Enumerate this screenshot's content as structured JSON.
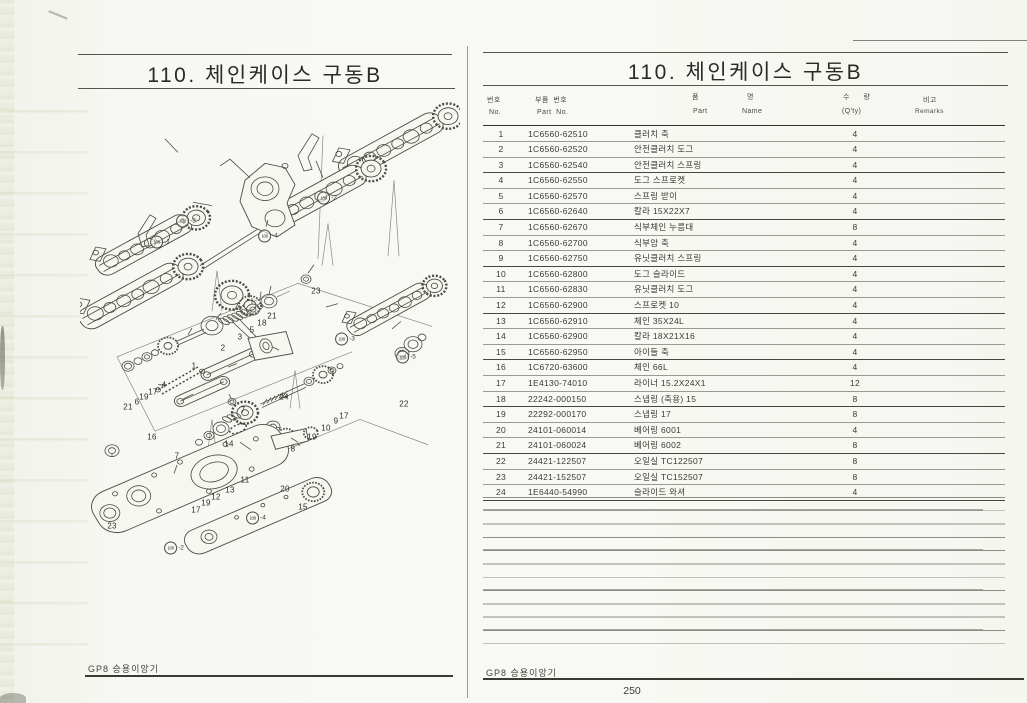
{
  "colors": {
    "paper": "#f6f6f2",
    "ink": "#3c3c36",
    "rule": "#8d8d85"
  },
  "left_page": {
    "title": "110. 체인케이스 구동B",
    "footer": "GP8 승용이앙기",
    "diagram": {
      "callouts": [
        {
          "label": "1",
          "x": 194,
          "y": 366
        },
        {
          "label": "2",
          "x": 223,
          "y": 348
        },
        {
          "label": "3",
          "x": 240,
          "y": 337
        },
        {
          "label": "4",
          "x": 164,
          "y": 385
        },
        {
          "label": "5",
          "x": 252,
          "y": 330
        },
        {
          "label": "6",
          "x": 137,
          "y": 402
        },
        {
          "label": "7",
          "x": 243,
          "y": 410
        },
        {
          "label": "7",
          "x": 177,
          "y": 456
        },
        {
          "label": "8",
          "x": 293,
          "y": 449
        },
        {
          "label": "9",
          "x": 336,
          "y": 421
        },
        {
          "label": "10",
          "x": 326,
          "y": 428
        },
        {
          "label": "11",
          "x": 245,
          "y": 480
        },
        {
          "label": "12",
          "x": 216,
          "y": 497
        },
        {
          "label": "13",
          "x": 230,
          "y": 490
        },
        {
          "label": "14",
          "x": 229,
          "y": 444
        },
        {
          "label": "15",
          "x": 303,
          "y": 507
        },
        {
          "label": "16",
          "x": 152,
          "y": 437
        },
        {
          "label": "17",
          "x": 153,
          "y": 392
        },
        {
          "label": "17",
          "x": 344,
          "y": 416
        },
        {
          "label": "17",
          "x": 196,
          "y": 510
        },
        {
          "label": "18",
          "x": 262,
          "y": 323
        },
        {
          "label": "19",
          "x": 144,
          "y": 397
        },
        {
          "label": "19",
          "x": 312,
          "y": 437
        },
        {
          "label": "19",
          "x": 206,
          "y": 503
        },
        {
          "label": "20",
          "x": 285,
          "y": 489
        },
        {
          "label": "21",
          "x": 272,
          "y": 316
        },
        {
          "label": "21",
          "x": 128,
          "y": 407
        },
        {
          "label": "22",
          "x": 404,
          "y": 404
        },
        {
          "label": "23",
          "x": 316,
          "y": 291
        },
        {
          "label": "23",
          "x": 112,
          "y": 526
        },
        {
          "label": "24",
          "x": 284,
          "y": 397
        }
      ],
      "ref_callouts": [
        {
          "text": "108",
          "suffix": "-1",
          "x": 160,
          "y": 242
        },
        {
          "text": "108",
          "suffix": "-2",
          "x": 327,
          "y": 198
        },
        {
          "text": "108",
          "suffix": "-3",
          "x": 186,
          "y": 221
        },
        {
          "text": "108",
          "suffix": "-4",
          "x": 268,
          "y": 236
        },
        {
          "text": "108",
          "suffix": "-3",
          "x": 345,
          "y": 339
        },
        {
          "text": "108",
          "suffix": "-5",
          "x": 406,
          "y": 357
        },
        {
          "text": "108",
          "suffix": "-4",
          "x": 256,
          "y": 518
        },
        {
          "text": "108",
          "suffix": "-2",
          "x": 174,
          "y": 548
        }
      ]
    }
  },
  "right_page": {
    "title": "110. 체인케이스 구동B",
    "footer": "GP8 승용이앙기",
    "page_number": "250",
    "table": {
      "headers": {
        "no_kr": "번호",
        "no_en": "No.",
        "part_kr": "부품  번호",
        "part_en": "Part  No.",
        "name_kr_a": "품",
        "name_kr_b": "명",
        "name_en_a": "Part",
        "name_en_b": "Name",
        "qty_kr": "수 량",
        "qty_en": "(Q'ty)",
        "remarks_kr": "비고",
        "remarks_en": "Remarks"
      },
      "rows": [
        {
          "no": "1",
          "part": "1C6560-62510",
          "name": "클러치 축",
          "qty": "4",
          "remarks": ""
        },
        {
          "no": "2",
          "part": "1C6560-62520",
          "name": "안전클러치 도그",
          "qty": "4",
          "remarks": ""
        },
        {
          "no": "3",
          "part": "1C6560-62540",
          "name": "안전클러치 스프링",
          "qty": "4",
          "remarks": ""
        },
        {
          "no": "4",
          "part": "1C6560-62550",
          "name": "도그 스프로켓",
          "qty": "4",
          "remarks": ""
        },
        {
          "no": "5",
          "part": "1C6560-62570",
          "name": "스프링 받이",
          "qty": "4",
          "remarks": ""
        },
        {
          "no": "6",
          "part": "1C6560-62640",
          "name": "칼라 15X22X7",
          "qty": "4",
          "remarks": ""
        },
        {
          "no": "7",
          "part": "1C6560-62670",
          "name": "식부체인 누름대",
          "qty": "8",
          "remarks": ""
        },
        {
          "no": "8",
          "part": "1C6560-62700",
          "name": "식부암 축",
          "qty": "4",
          "remarks": ""
        },
        {
          "no": "9",
          "part": "1C6560-62750",
          "name": "유닛클러치 스프링",
          "qty": "4",
          "remarks": ""
        },
        {
          "no": "10",
          "part": "1C6560-62800",
          "name": "도그 슬라이드",
          "qty": "4",
          "remarks": ""
        },
        {
          "no": "11",
          "part": "1C6560-62830",
          "name": "유닛클러치 도그",
          "qty": "4",
          "remarks": ""
        },
        {
          "no": "12",
          "part": "1C6560-62900",
          "name": "스프로켓 10",
          "qty": "4",
          "remarks": ""
        },
        {
          "no": "13",
          "part": "1C6560-62910",
          "name": "체인 35X24L",
          "qty": "4",
          "remarks": ""
        },
        {
          "no": "14",
          "part": "1C6560-62900",
          "name": "칼라 18X21X16",
          "qty": "4",
          "remarks": ""
        },
        {
          "no": "15",
          "part": "1C6560-62950",
          "name": "아이들 축",
          "qty": "4",
          "remarks": ""
        },
        {
          "no": "16",
          "part": "1C6720-63600",
          "name": "체인 66L",
          "qty": "4",
          "remarks": ""
        },
        {
          "no": "17",
          "part": "1E4130-74010",
          "name": "라이너 15.2X24X1",
          "qty": "12",
          "remarks": ""
        },
        {
          "no": "18",
          "part": "22242-000150",
          "name": "스냅링 (축용) 15",
          "qty": "8",
          "remarks": ""
        },
        {
          "no": "19",
          "part": "22292-000170",
          "name": "스냅링 17",
          "qty": "8",
          "remarks": ""
        },
        {
          "no": "20",
          "part": "24101-060014",
          "name": "베어링 6001",
          "qty": "4",
          "remarks": ""
        },
        {
          "no": "21",
          "part": "24101-060024",
          "name": "베어링 6002",
          "qty": "8",
          "remarks": ""
        },
        {
          "no": "22",
          "part": "24421-122507",
          "name": "오일실 TC122507",
          "qty": "8",
          "remarks": ""
        },
        {
          "no": "23",
          "part": "24421-152507",
          "name": "오일실 TC152507",
          "qty": "8",
          "remarks": ""
        },
        {
          "no": "24",
          "part": "1E6440-54990",
          "name": "슬라이드 와셔",
          "qty": "4",
          "remarks": ""
        }
      ]
    }
  }
}
